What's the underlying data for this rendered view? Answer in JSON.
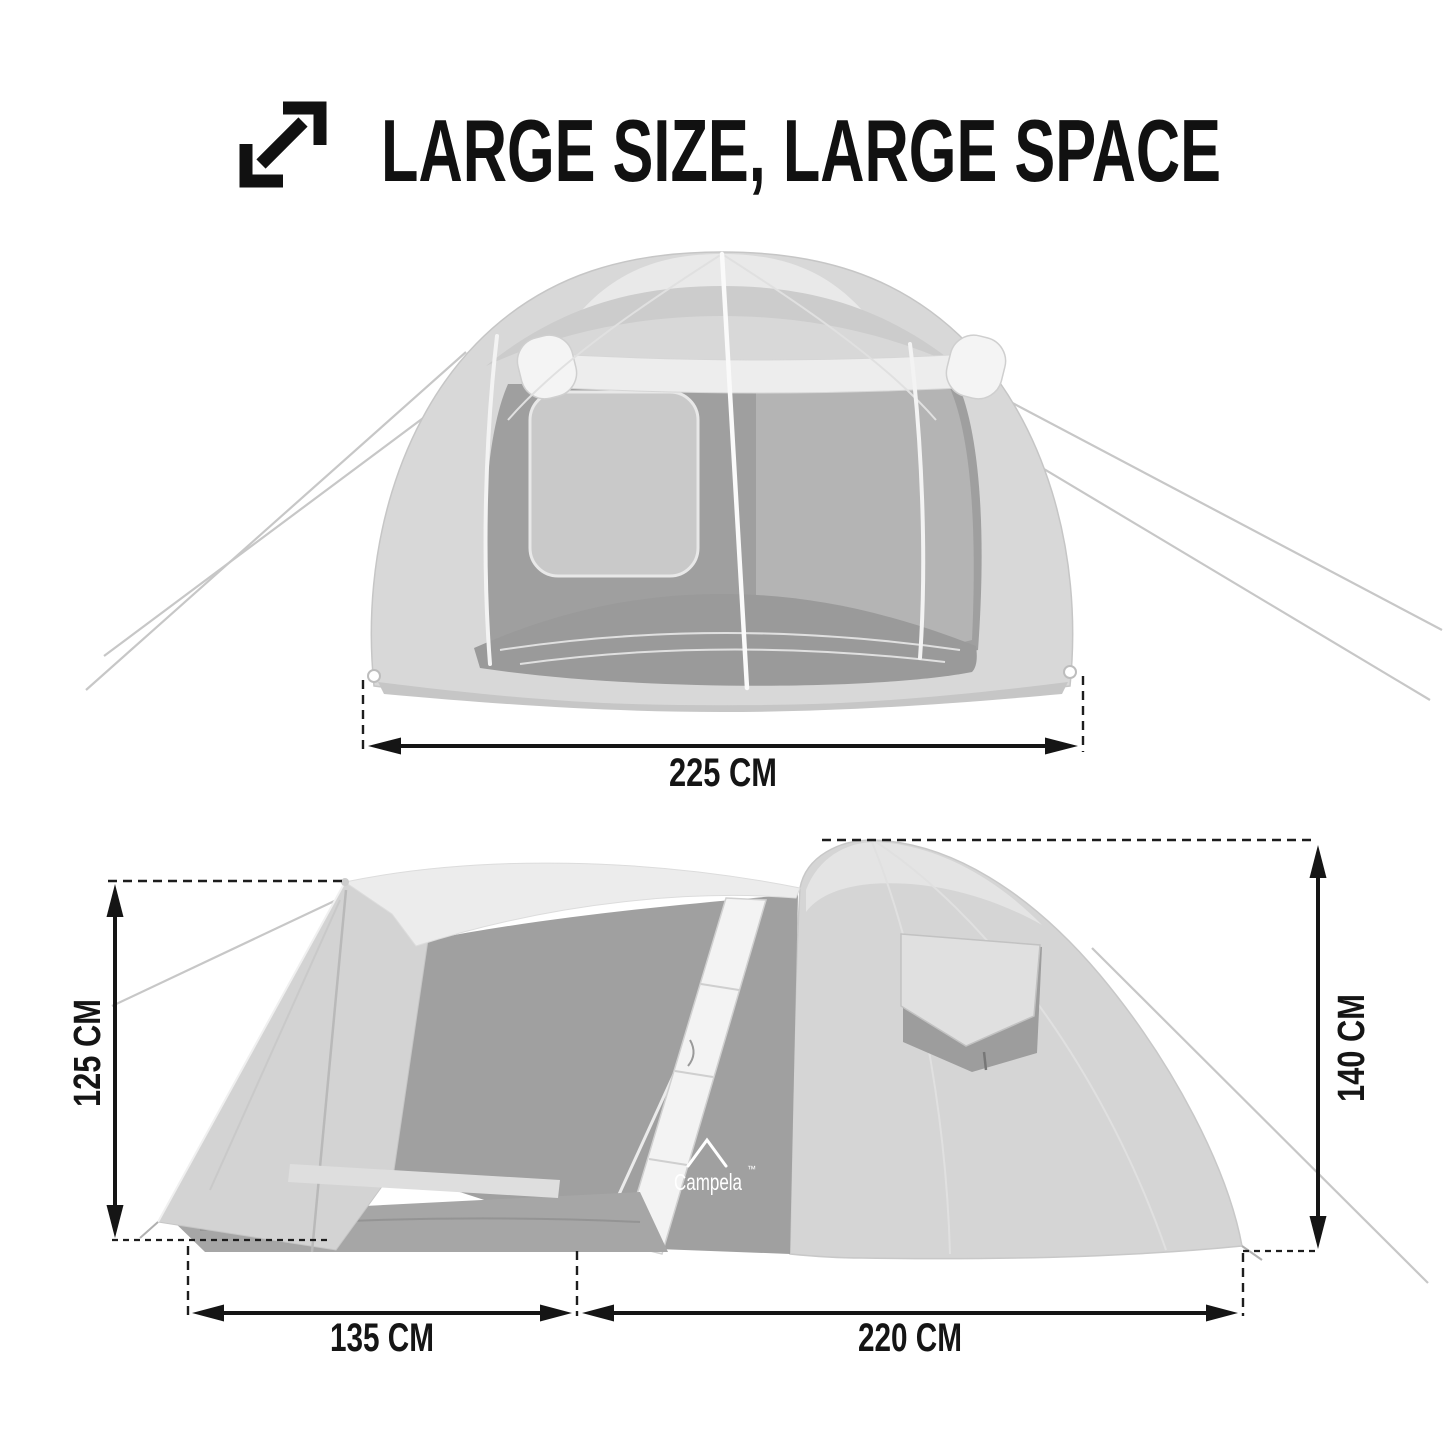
{
  "header": {
    "title": "LARGE SIZE, LARGE SPACE",
    "icon": "expand-diagonal-arrows-icon"
  },
  "front_view": {
    "name": "tent front view",
    "width": {
      "label": "225 CM",
      "value": 225,
      "unit": "CM"
    }
  },
  "side_view": {
    "name": "tent side view",
    "brand_logo": {
      "text": "Campela",
      "trademark": "™",
      "icon": "tent-peak-icon"
    },
    "vestibule_height": {
      "label": "125 CM",
      "value": 125,
      "unit": "CM"
    },
    "dome_height": {
      "label": "140 CM",
      "value": 140,
      "unit": "CM"
    },
    "vestibule_length": {
      "label": "135 CM",
      "value": 135,
      "unit": "CM"
    },
    "dome_length": {
      "label": "220 CM",
      "value": 220,
      "unit": "CM"
    }
  },
  "palette": {
    "background": "#ffffff",
    "text": "#151515",
    "tent_fly": "#d6d6d6",
    "tent_highlight": "#ebebeb",
    "tent_interior": "#a0a0a0",
    "tent_window": "#c9c9c9",
    "tent_floor": "#a6a6a6",
    "pole": "#fafafa",
    "guy_line": "#c7c7c7",
    "logo_text": "#ffffff"
  }
}
